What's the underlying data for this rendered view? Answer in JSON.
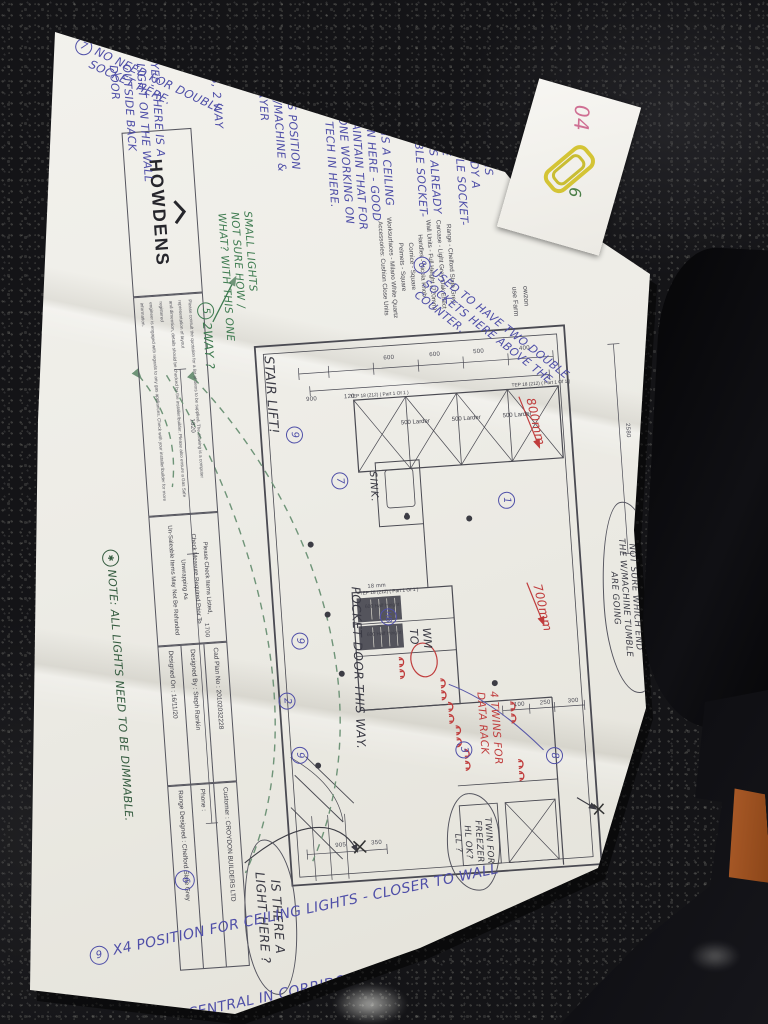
{
  "title_block": {
    "brand": "HOWDENS",
    "disclaimer": "Please consult the quotation for a list of items to be supplied. The drawing is a computer representation of layout\nand dimension, details should be checked by the installer/builder. Please also ensure a Gas Safe registered\nengineer is engaged with regards to any gas appliances. Check with your installer/builder for more information.",
    "check_notice": "Please Check Items Listed,\nCheck Measure Required Prior To Unwrapping As\nUn-Saleable Items May Not Be Refunded",
    "cad_plan_no": "Cad Plan No : 20102032228",
    "designed_by": "Designed By : Steph Rankin",
    "designed_on": "Designed On : 16/11/20",
    "customer": "Customer : CROYDON BUILDERS LTD",
    "phone": "Phone :",
    "range_designed": "Range Designed :  Chelford Slate Grey"
  },
  "spec_panel": {
    "lines": "Range - Chelford Slate Grey\nCarcase - Light Grey Oak Effect\nWall Units - Full Height (720mm)\nHandles - Nicola Knob\nCornice - Square\nPelmets - Square\nWorksurfaces - Milano White Quartz\nAccessories: Cushion Close Units",
    "address_fragment": "owzon\nuse Farm"
  },
  "notes": {
    "heading": "NOTES!",
    "n1_num": "1",
    "n1": "THERE IS\nALREADY A\nDOUBLE SOCKET-\nHERE",
    "n2_num": "2",
    "n2": "THERE IS ALREADY\nA DOUBLE SOCKET-\nHERE.",
    "n3_num": "3",
    "n3": "YES, 2 WAY",
    "n4_num": "4",
    "n4": "THIS IS POSITION\nOF W/MACHINE &\nT/DRYER",
    "n5_num": "5",
    "n5": "THERE IS A CEILING\nSPOT IN HERE - GOOD\nTO MAINTAIN THAT FOR\nANYONE WORKING ON\nTHE TECH IN HERE.",
    "n6_num": "6",
    "n6": "YES, THERE IS A\nLIGHT ON THE WALL\nOUTSIDE BACK\nDOOR",
    "n7_num": "7",
    "n7": "NO NEED FOR DOUBLE\nSOCKET HERE.",
    "n8_num": "8",
    "n8": "USED TO HAVE TWO DOUBLE\nSOCKETS HERE ABOVE THE\nCOUNTER.",
    "n9_num": "9",
    "n9_line1": "X4  POSITION FOR CEILING LIGHTS - CLOSER TO WALL",
    "n9_line2": "( NOT CENTRAL IN CORRIDOR )",
    "star_sym": "✱",
    "star": "NOTE: ALL LIGHTS NEED TO BE DIMMABLE.",
    "small_lights": "SMALL LIGHTS\nNOT SURE HOW /\nWHAT? WITH THIS ONE",
    "two_way_num": "5",
    "two_way": "2WAY ?"
  },
  "clouds": {
    "wine_title": "NOTE",
    "wine": "NOT SURE WHICH END\nTHE W/MACHINE TUMBLE\nARE GOING",
    "freezer": "TWIN FOR\nFREEZER\nHL OK?\nLL ?",
    "light": "IS THERE A\nLIGHT HERE ?"
  },
  "plan": {
    "stair_lift": "STAIR LIFT!",
    "sink": "SINK.",
    "pocket_door": "POCKET DOOR THIS WAY.",
    "wm": "WM\nTO",
    "larder_label": "500 Larder",
    "tep_label": "TEP 18 (212) ( Part 1 Of 1 )",
    "half_height_label": "600 Half Height",
    "red_800": "800mm",
    "red_700": "700mm",
    "data_rack": "4 TWINS FOR\nDATA RACK",
    "circled": {
      "c1": "1",
      "c2": "2",
      "c3": "3",
      "c6": "6",
      "c7": "7",
      "c8": "8",
      "c9": "9",
      "hb": "HB"
    }
  },
  "dims": {
    "d2580": "2580",
    "d1820": "1820",
    "d1700": "1700",
    "d900": "900",
    "d120": "120",
    "d400": "400",
    "d500": "500",
    "d600": "600",
    "d250": "250",
    "d300": "300",
    "d100": "100",
    "d905": "905",
    "d350": "350",
    "d1050": "1050",
    "d18mm": "18 mm"
  },
  "tape": {
    "pink_mark": "04",
    "green_mark": "6"
  }
}
